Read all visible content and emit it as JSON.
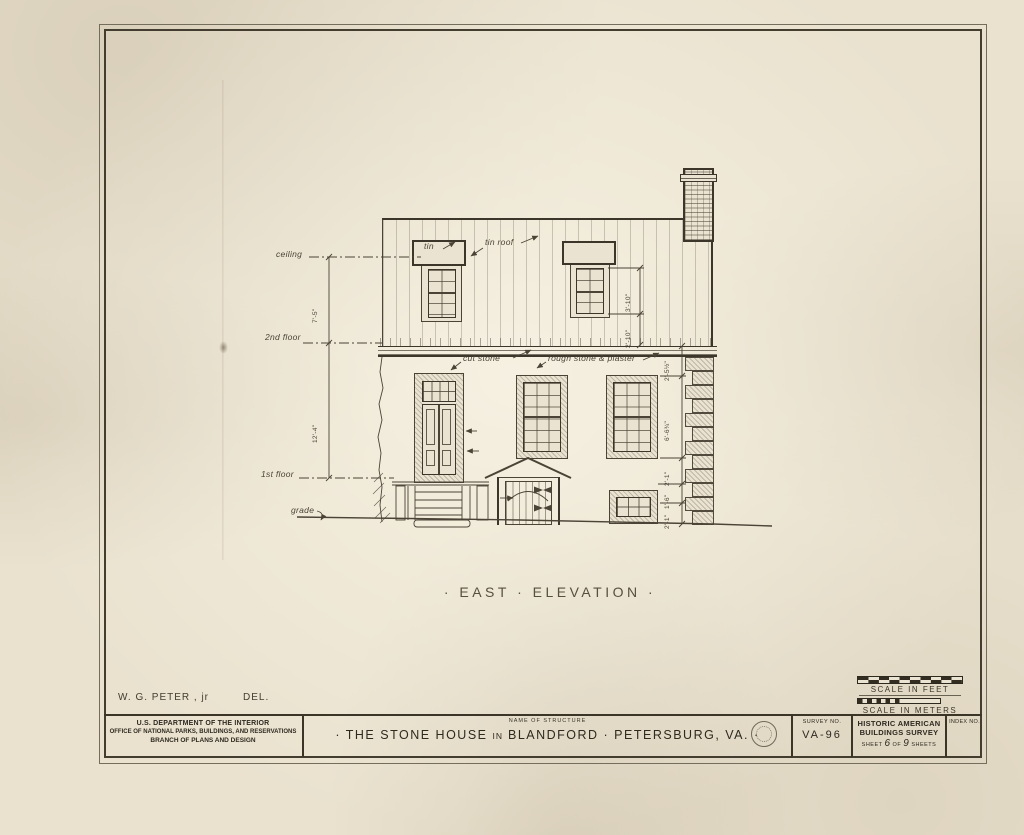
{
  "drawing": {
    "caption": "· EAST · ELEVATION ·",
    "floor_labels": {
      "ceiling": "ceiling",
      "second": "2nd floor",
      "first": "1st floor",
      "grade": "grade"
    },
    "material_labels": {
      "tin": "tin",
      "tin_roof": "tin roof",
      "cut_stone": "cut stone",
      "rough_stone": "rough stone & plaster"
    },
    "dims": {
      "d1": "7'-5\"",
      "d2": "12'-4\"",
      "d3": "3'-10\"",
      "d4": "2'-10\"",
      "d5": "2'-5½\"",
      "d6": "6'-6¾\"",
      "d7": "2'-1\"",
      "d8": "1'-6\"",
      "d9": "2'-1\""
    }
  },
  "scale_block": {
    "feet_label": "SCALE IN FEET",
    "meters_label": "SCALE IN METERS"
  },
  "title_block": {
    "delineator_name": "W. G. PETER , jr",
    "delineator_role": "DEL.",
    "agency": [
      "U.S. DEPARTMENT OF THE INTERIOR",
      "OFFICE OF NATIONAL PARKS, BUILDINGS, AND RESERVATIONS",
      "BRANCH OF PLANS AND DESIGN"
    ],
    "name_of_structure_label": "NAME OF STRUCTURE",
    "structure_name_left": "· THE STONE HOUSE",
    "structure_name_in": "IN",
    "structure_name_right": "BLANDFORD · PETERSBURG, VA. ·",
    "survey_label": "SURVEY NO.",
    "survey_no": "VA-96",
    "habs_line1": "HISTORIC AMERICAN",
    "habs_line2": "BUILDINGS SURVEY",
    "sheet_word": "SHEET",
    "sheet_num": "6",
    "of_word": "OF",
    "sheet_total": "9",
    "sheets_word": "SHEETS",
    "index_label": "INDEX NO."
  }
}
